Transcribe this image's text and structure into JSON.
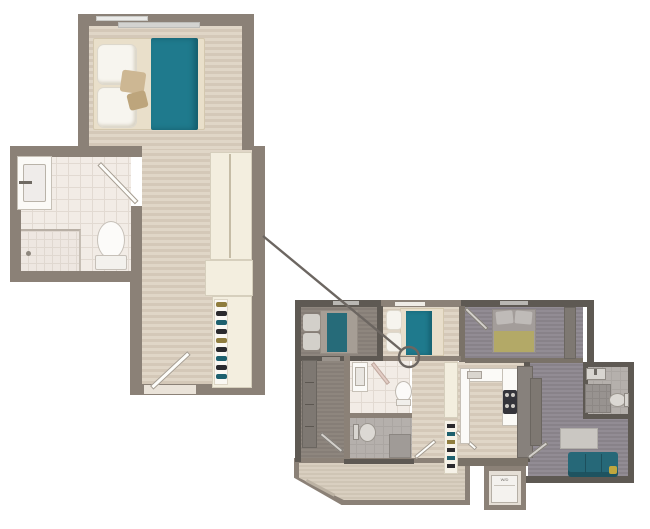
{
  "page": {
    "background": "#ffffff",
    "kind": "apartment floor plan with unit callout"
  },
  "colors": {
    "bg": "#ffffff",
    "wall": "#8b8177",
    "wallDark": "#5e5953",
    "woodA": "#e0d6c7",
    "woodB": "#d4c8b8",
    "tile": "#f2ece6",
    "cream": "#f3eedf",
    "teal": "#1f7a8d",
    "tealDim": "#266b79",
    "yellow": "#b3a967",
    "sofa": "#266878",
    "line": "#6c6661",
    "shoeOlive": "#8f7d3e",
    "shoeDark": "#2a2a2e",
    "shoeTeal": "#1d606e"
  },
  "detail_plan": {
    "name": "unit-detail-plan",
    "rooms": [
      "bedroom",
      "bathroom",
      "hallway",
      "closet"
    ],
    "fixtures": [
      "bed",
      "pillows",
      "blanket",
      "vanity-sink",
      "shower",
      "toilet",
      "door-swing",
      "wardrobe",
      "shoe-shelf",
      "entry-door",
      "windows"
    ]
  },
  "overview_plan": {
    "name": "floor-overview-plan",
    "highlighted_room": "studio unit (bright)",
    "rooms": [
      "bedroom-left",
      "bedroom-middle",
      "bedroom-right",
      "bathroom-middle",
      "bathroom-left-unit",
      "bathroom-right",
      "kitchen",
      "corridor",
      "living-room",
      "balcony"
    ],
    "appliance_label": "W/D"
  },
  "callout": {
    "shape": "circle",
    "from": "unit-detail-plan",
    "to": "overview-unit-door"
  }
}
